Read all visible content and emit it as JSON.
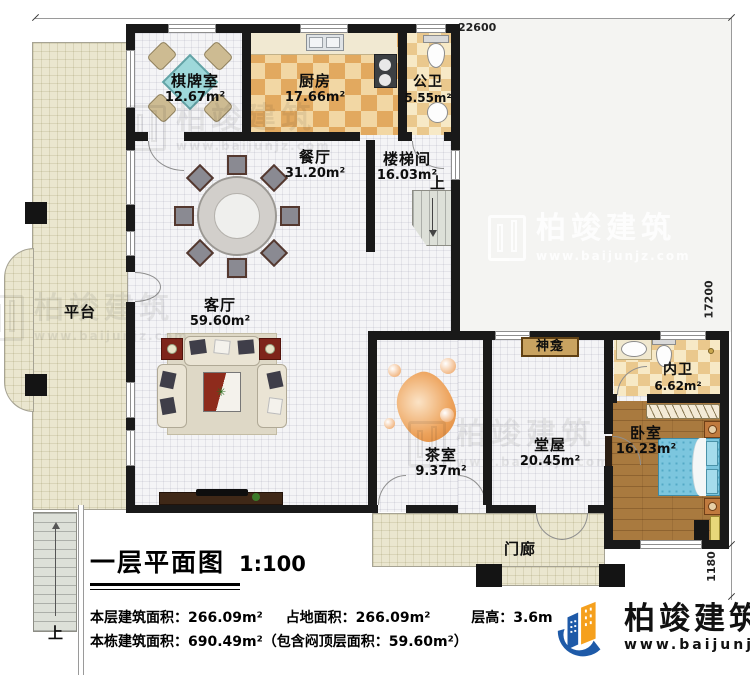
{
  "plan": {
    "dimensions": {
      "top": "22600",
      "right_height": "17200",
      "porch_depth": "1180"
    },
    "rooms": {
      "qipaishi": {
        "name": "棋牌室",
        "area": "12.67m²"
      },
      "chufang": {
        "name": "厨房",
        "area": "17.66m²"
      },
      "gongwei": {
        "name": "公卫",
        "area": "5.55m²"
      },
      "canting": {
        "name": "餐厅",
        "area": "31.20m²"
      },
      "loutijian": {
        "name": "楼梯间",
        "area": "16.03m²"
      },
      "keting": {
        "name": "客厅",
        "area": "59.60m²"
      },
      "pingtai": {
        "name": "平台"
      },
      "chashi": {
        "name": "茶室",
        "area": "9.37m²"
      },
      "shenkan": {
        "name": "神龛"
      },
      "tangwu": {
        "name": "堂屋",
        "area": "20.45m²"
      },
      "neiwei": {
        "name": "内卫",
        "area": "6.62m²"
      },
      "woshi": {
        "name": "卧室",
        "area": "16.23m²"
      },
      "menlang": {
        "name": "门廊"
      }
    },
    "labels": {
      "up": "上"
    }
  },
  "title_block": {
    "title": "一层平面图",
    "scale": "1:100",
    "stats_line1": [
      {
        "text": "本层建筑面积：266.09m²"
      },
      {
        "text": "占地面积：266.09m²"
      },
      {
        "text": "层高：3.6m"
      }
    ],
    "stats_line2": "本栋建筑面积：690.49m²（包含闷顶层面积：59.60m²）"
  },
  "branding": {
    "company": "柏竣建筑",
    "website": "www.baijunjz.com"
  },
  "colors": {
    "wall": "#191919",
    "platform_floor": "#eae6cf",
    "kitchen_tile": "#e2a95f",
    "bath_tile": "#eac88d",
    "wood_floor": "#a97a3f",
    "bed_blue": "#7cc6de",
    "logo_blue": "#1e5aa8",
    "logo_orange": "#f5a01d"
  }
}
